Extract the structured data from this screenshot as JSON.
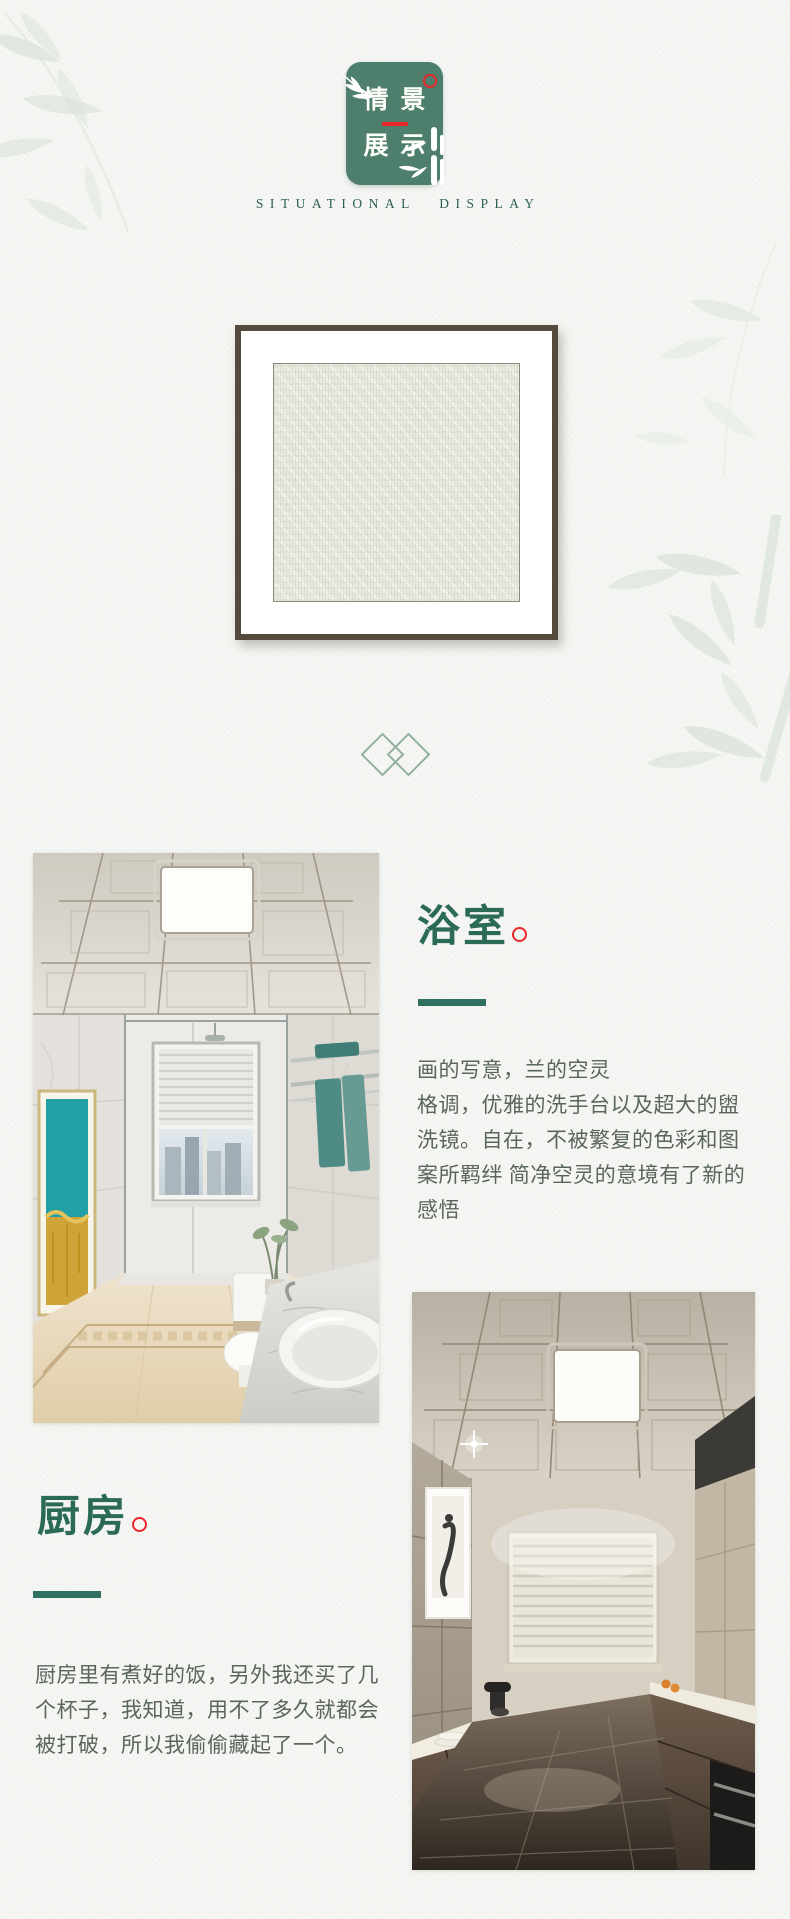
{
  "header": {
    "badge": {
      "line1": "情景",
      "line2": "展示"
    },
    "subtitle": "SITUATIONAL DISPLAY"
  },
  "sections": [
    {
      "id": "bathroom",
      "title": "浴室",
      "paragraphs": [
        "画的写意，兰的空灵",
        "格调，优雅的洗手台以及超大的盥洗镜。自在，不被繁复的色彩和图案所羁绊 简净空灵的意境有了新的感悟"
      ],
      "photo_alt": "bathroom with coffered ceiling light panel, glass shower, teal-gold wall art, marble vanity and round sink"
    },
    {
      "id": "kitchen",
      "title": "厨房",
      "paragraphs": [
        "厨房里有煮好的饭，另外我还买了几个杯子，我知道，用不了多久就都会被打破，所以我偷偷藏起了一个。"
      ],
      "photo_alt": "galley kitchen with coffered ceiling light panel, blinds window, brown cabinets and black oven"
    }
  ],
  "theme": {
    "badge_green": "#4e7e6c",
    "title_green": "#2b6a56",
    "dash_green": "#2f7060",
    "accent_red": "#e8262a",
    "subtitle_teal": "#2f5f55",
    "body_text": "#5a655e",
    "frame_border": "#56493d",
    "diamond_green": "#92afa1",
    "page_bg": "#f6f7f4",
    "swatch_bg": "#e9eae1",
    "bamboo": "#dce5dc"
  }
}
